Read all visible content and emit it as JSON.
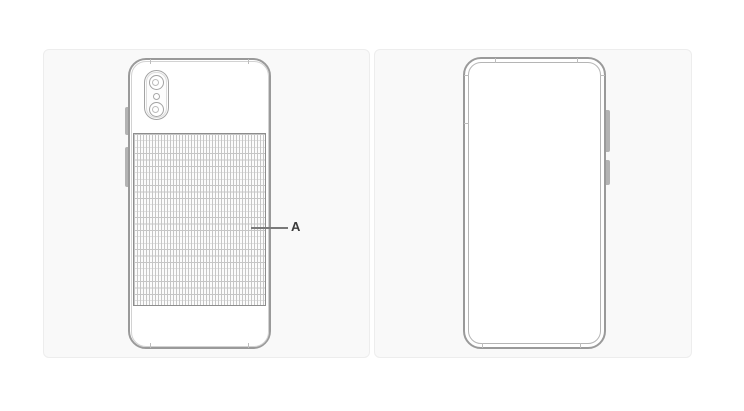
{
  "figure": {
    "label_a": "A",
    "panels": {
      "left": {
        "name": "phone-back-view"
      },
      "right": {
        "name": "phone-front-view"
      }
    },
    "colors": {
      "page_background": "#ffffff",
      "panel_background": "#f9f9f9",
      "panel_border": "#ededed",
      "phone_outline": "#9a9a9a",
      "grid_line": "#c6c6c6",
      "grid_border": "#8d8d8d",
      "button_fill": "#b3b3b3",
      "label_text": "#3c3c3c"
    }
  }
}
